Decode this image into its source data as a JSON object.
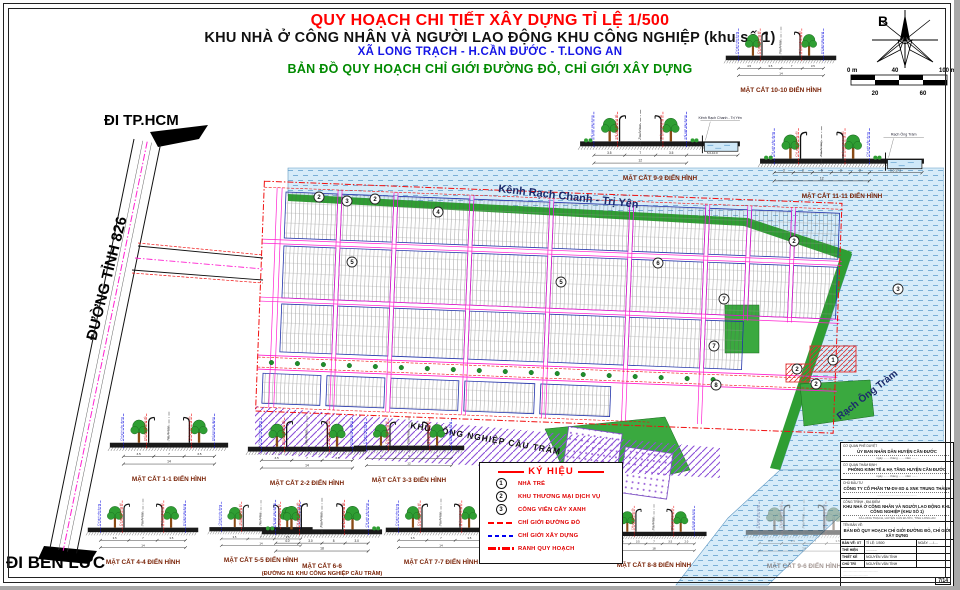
{
  "title": {
    "line1": "QUY HOẠCH CHI TIẾT XÂY DỰNG TỈ LỆ 1/500",
    "line2": "KHU NHÀ Ở CÔNG NHÂN VÀ NGƯỜI LAO ĐỘNG KHU CÔNG NGHIỆP (khu số 1)",
    "line3": "XÃ LONG TRẠCH - H.CẦN ĐƯỚC - T.LONG AN",
    "line4": "BẢN ĐỒ QUY HOẠCH CHỈ GIỚI ĐƯỜNG ĐỎ, CHỈ GIỚI XÂY DỰNG"
  },
  "compass": {
    "north_label": "B"
  },
  "scalebar": {
    "top_labels": [
      "0 m",
      "40",
      "100 m"
    ],
    "bottom_labels": [
      "20",
      "60"
    ]
  },
  "map": {
    "labels": {
      "canal": "Kênh Rạch Chanh - Trị Yên",
      "rach": "Rạch Ông Tràm",
      "industrial": "KHU CÔNG NGHIỆP CẦU TRÀM",
      "road": "ĐƯỜNG TỈNH 826",
      "to_hcm": "ĐI TP.HCM",
      "to_benluc": "ĐI BẾN LỨC"
    },
    "markers": [
      {
        "x": 319,
        "y": 197,
        "n": "2"
      },
      {
        "x": 347,
        "y": 201,
        "n": "3"
      },
      {
        "x": 375,
        "y": 199,
        "n": "2"
      },
      {
        "x": 438,
        "y": 212,
        "n": "4"
      },
      {
        "x": 352,
        "y": 262,
        "n": "5"
      },
      {
        "x": 561,
        "y": 282,
        "n": "5"
      },
      {
        "x": 658,
        "y": 263,
        "n": "6"
      },
      {
        "x": 724,
        "y": 299,
        "n": "7"
      },
      {
        "x": 794,
        "y": 241,
        "n": "2"
      },
      {
        "x": 898,
        "y": 289,
        "n": "3"
      },
      {
        "x": 833,
        "y": 360,
        "n": "1"
      },
      {
        "x": 797,
        "y": 369,
        "n": "2"
      },
      {
        "x": 816,
        "y": 384,
        "n": "2"
      },
      {
        "x": 714,
        "y": 346,
        "n": "7"
      },
      {
        "x": 716,
        "y": 385,
        "n": "8"
      }
    ]
  },
  "section_axis_labels": [
    "Chỉ giới xây dựng",
    "Chỉ giới đường đỏ",
    "Tim đường"
  ],
  "sections": [
    {
      "id": "10-10",
      "label": "MẶT CẮT 10-10 ĐIỂN HÌNH",
      "dims": [
        "4.5",
        "3.5",
        "7",
        "3.5"
      ],
      "total": "14",
      "x": 722,
      "y": 14,
      "w": 118
    },
    {
      "id": "9-9",
      "label": "MẶT CẮT 9-9 ĐIỂN HÌNH",
      "side_label": "Kênh Rạch Chanh - Trị Yên",
      "dims": [
        "3.5",
        "7",
        "3.5"
      ],
      "total": "12",
      "extra": "5.0-10.0",
      "water": true,
      "grass": true,
      "x": 576,
      "y": 96,
      "w": 168
    },
    {
      "id": "11-11",
      "label": "MẶT CẮT 11-11 ĐIỂN HÌNH",
      "side_label": "Rạch Ông Tràm",
      "dims": [
        "3",
        "3",
        "6",
        "3",
        "3"
      ],
      "total": "12",
      "extra": "5.0-17.2",
      "water": true,
      "grass": true,
      "x": 756,
      "y": 112,
      "w": 172
    },
    {
      "id": "1-1",
      "label": "MẶT CẮT 1-1 ĐIỂN HÌNH",
      "dims": [
        "3.5",
        "7",
        "3.5"
      ],
      "total": "14",
      "x": 106,
      "y": 398,
      "w": 126
    },
    {
      "id": "2-2",
      "label": "MẶT CẮT 2-2 ĐIỂN HÌNH",
      "dims": [
        "3.5",
        "7",
        "3.5"
      ],
      "total": "14",
      "x": 244,
      "y": 402,
      "w": 126
    },
    {
      "id": "3-3",
      "label": "MẶT CẮT 3-3 ĐIỂN HÌNH",
      "dims": [
        "3",
        "6",
        "3"
      ],
      "total": "12",
      "x": 350,
      "y": 404,
      "w": 118
    },
    {
      "id": "4-4",
      "label": "MẶT CẮT 4-4 ĐIỂN HÌNH",
      "dims": [
        "3.5",
        "7",
        "3.5"
      ],
      "total": "14",
      "x": 84,
      "y": 486,
      "w": 118
    },
    {
      "id": "5-5",
      "label": "MẶT CẮT 5-5 ĐIỂN HÌNH",
      "dims": [
        "3.5",
        "7",
        "3.5"
      ],
      "total": "14",
      "x": 206,
      "y": 488,
      "w": 110
    },
    {
      "id": "6-6",
      "label": "MẶT CẮT 6-6",
      "sublabel": "(ĐƯỜNG N1 KHU CÔNG NGHIỆP CẦU TRÀM)",
      "dims": [
        "4.0",
        "3.0",
        "8",
        "3.0"
      ],
      "total": "18",
      "grass": true,
      "x": 258,
      "y": 484,
      "w": 128
    },
    {
      "id": "7-7",
      "label": "MẶT CẮT 7-7 ĐIỂN HÌNH",
      "dims": [
        "3.5",
        "7",
        "3.5"
      ],
      "total": "14",
      "x": 382,
      "y": 486,
      "w": 118
    },
    {
      "id": "8-8",
      "label": "MẶT CẮT 8-8 ĐIỂN HÌNH",
      "dims": [
        "2.0",
        "3.5",
        "7",
        "3.5",
        "2.0"
      ],
      "total": "18",
      "x": 598,
      "y": 492,
      "w": 112
    },
    {
      "id": "9-6",
      "label": "MẶT CẮT 9-6 ĐIỂN HÌNH",
      "dims": [
        "2.0",
        "3.5",
        "7",
        "3.5"
      ],
      "total": "14",
      "faded": true,
      "x": 742,
      "y": 486,
      "w": 124
    }
  ],
  "legend": {
    "title": "KÝ HIỆU",
    "items": [
      {
        "symbol": "1",
        "label": "NHÀ TRẺ"
      },
      {
        "symbol": "2",
        "label": "KHU THƯƠNG MẠI DỊCH VỤ"
      },
      {
        "symbol": "3",
        "label": "CÔNG VIÊN CÂY XANH"
      },
      {
        "line": "sw-red-dash",
        "label": "CHỈ GIỚI ĐƯỜNG ĐỎ"
      },
      {
        "line": "sw-blue-dash",
        "label": "CHỈ GIỚI XÂY DỰNG"
      },
      {
        "line": "sw-red-dashdot",
        "label": "RANH QUY HOẠCH"
      }
    ]
  },
  "titleblock": {
    "rows": [
      {
        "label": "CƠ QUAN PHÊ DUYỆT",
        "value": "ỦY BAN NHÂN DÂN HUYỆN CẦN ĐƯỚC",
        "note": "ngày ....... tháng ....... năm ......."
      },
      {
        "label": "CƠ QUAN THẨM ĐỊNH",
        "value": "PHÒNG KINH TẾ & HẠ TẦNG HUYỆN CẦN ĐƯỚC",
        "note": "ngày ....... tháng ....... năm ......."
      },
      {
        "label": "CHỦ ĐẦU TƯ",
        "value": "CÔNG TY CỔ PHẦN TM-DV-XD & XNK TRUNG THÀNH",
        "note": "..............................................."
      },
      {
        "label": "CÔNG TRÌNH - ĐỊA ĐIỂM",
        "value": "KHU NHÀ Ở CÔNG NHÂN VÀ NGƯỜI LAO ĐỘNG KHU CÔNG NGHIỆP (KHU SỐ 1)",
        "note": "XÃ LONG TRẠCH, HUYỆN CẦN ĐƯỚC, TỈNH LONG AN"
      },
      {
        "label": "TÊN BẢN VẼ:",
        "value": "BẢN ĐỒ QUY HOẠCH CHỈ GIỚI ĐƯỜNG ĐỎ, CHỈ GIỚI XÂY DỰNG",
        "note": ""
      }
    ],
    "table": {
      "header": [
        "BẢN VẼ: XT",
        "TỈ LỆ: 1/500",
        "NGÀY: ..../...."
      ],
      "rows": [
        [
          "THỂ HIỆN",
          "............"
        ],
        [
          "THIẾT KẾ",
          "NGUYỄN VĂN TÌNH"
        ],
        [
          "CHỦ TRÌ",
          "NGUYỄN VĂN TÌNH"
        ]
      ]
    },
    "page_number": "7/14"
  },
  "colors": {
    "title_red": "#ff0000",
    "title_blue": "#1414e6",
    "title_green": "#008a00",
    "water": "#d7ecf9",
    "water_line": "#6fa8d2",
    "road_magenta": "#ff20d0",
    "red_line": "#f01010",
    "blue_line": "#1515e0",
    "block_outline": "#2233aa",
    "industrial_purple": "#8b4fd8",
    "green_area": "#2f9e33"
  }
}
